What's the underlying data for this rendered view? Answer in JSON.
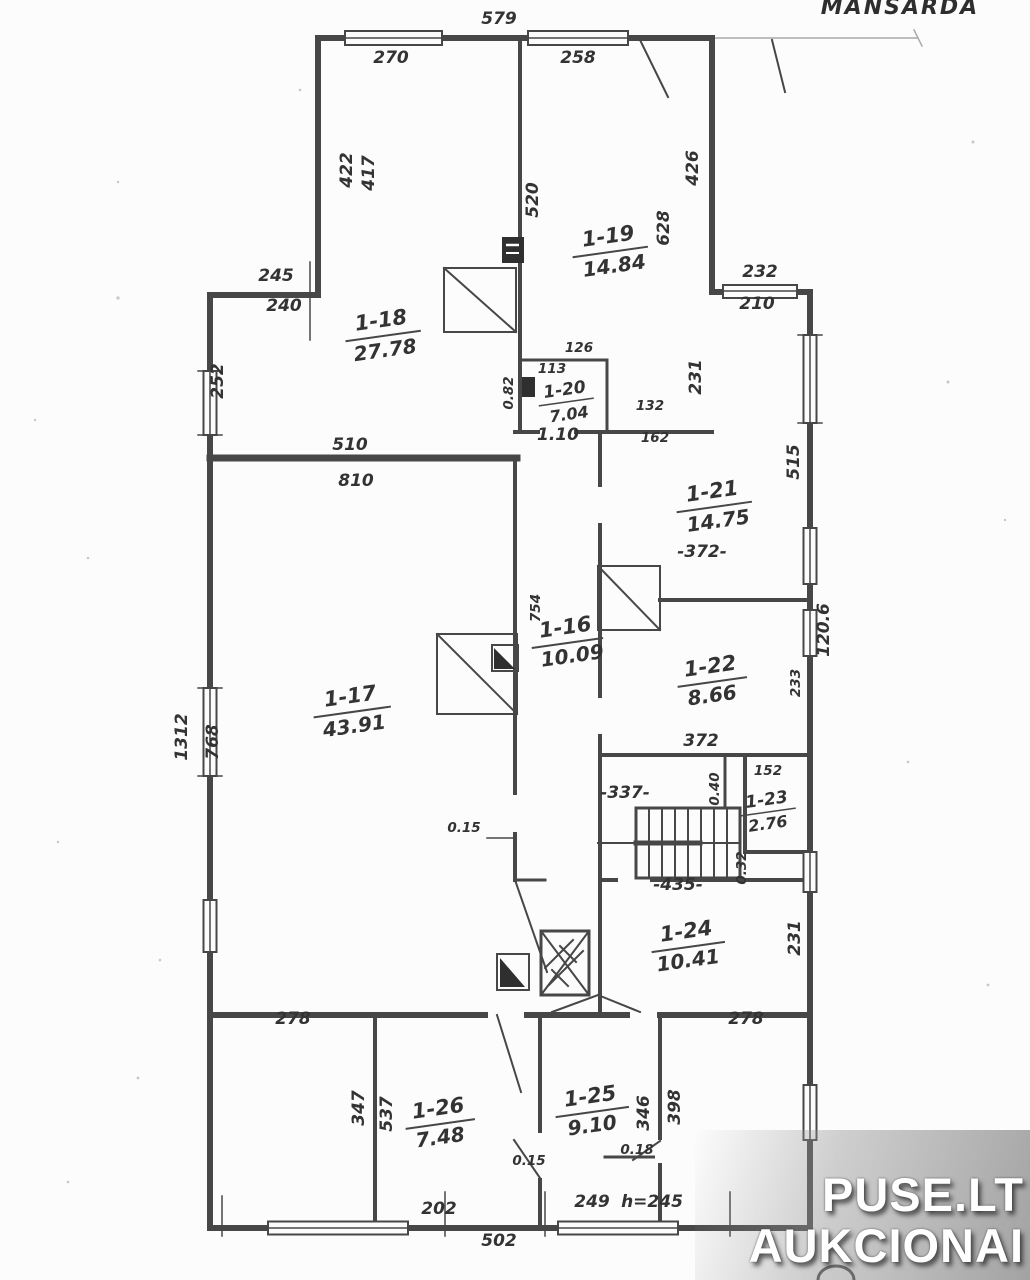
{
  "title": "MANSARDA",
  "watermark": {
    "line1": "PUSE.LT",
    "line2": "AUKCIONAI"
  },
  "rooms": [
    {
      "id": "1-18",
      "area": "27.78"
    },
    {
      "id": "1-19",
      "area": "14.84"
    },
    {
      "id": "1-20",
      "area": "7.04"
    },
    {
      "id": "1-21",
      "area": "14.75"
    },
    {
      "id": "1-22",
      "area": "8.66"
    },
    {
      "id": "1-23",
      "area": "2.76"
    },
    {
      "id": "1-16",
      "area": "10.09"
    },
    {
      "id": "1-17",
      "area": "43.91"
    },
    {
      "id": "1-24",
      "area": "10.41"
    },
    {
      "id": "1-25",
      "area": "9.10"
    },
    {
      "id": "1-26",
      "area": "7.48"
    }
  ],
  "dims": {
    "top_total": "579",
    "top_window_left": "270",
    "top_window_right": "258",
    "upper_left_inner_a": "422",
    "upper_left_inner_b": "417",
    "step_upper": "245",
    "step_lower": "240",
    "left_wall_upper": "252",
    "r17_top_upper": "510",
    "r17_top_lower": "810",
    "r19_left_height": "520",
    "r19_mid_height": "628",
    "r19_right_height": "426",
    "top_right_window_a": "232",
    "top_right_window_b": "210",
    "r19_wall_right": "231",
    "r20_top": "126",
    "r20_inner_top": "113",
    "r20_left": "0.82",
    "r20_bottom": "1.10",
    "r20_right_a": "132",
    "r20_right_b": "162",
    "right_wall_upper": "515",
    "right_wall_total": "120.6",
    "r21_width": "-372-",
    "r22_width": "372",
    "r22_right_height": "233",
    "r23_top_width": "152",
    "stair_niche": "0.40",
    "stair_width_top": "-337-",
    "stair_width_bottom": "-435-",
    "stair_right": "0.32",
    "r16_height": "754",
    "corridor_door": "0.15",
    "left_wall_lower_a": "1312",
    "left_wall_lower_b": "768",
    "annex_top_left": "278",
    "annex_top_right": "278",
    "r24_right_height": "231",
    "r26_left_a": "347",
    "r26_left_b": "537",
    "r25_right_a": "346",
    "r25_right_b": "398",
    "r25_door": "0.18",
    "r26_door": "0.15",
    "bottom_left": "202",
    "bottom_mid": "249",
    "bottom_height_note": "h=245",
    "bottom_total": "502"
  }
}
